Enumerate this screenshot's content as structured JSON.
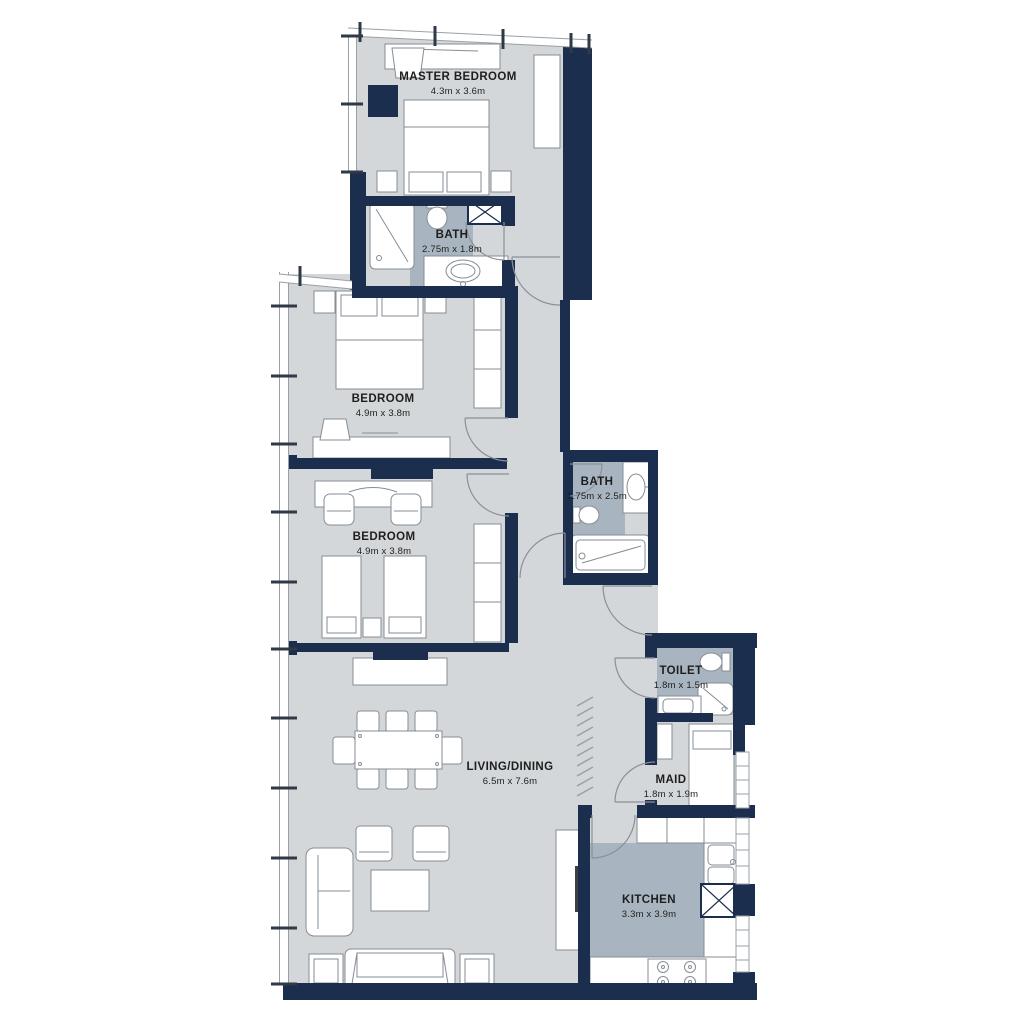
{
  "plan": {
    "title": "apartment-floor-plan",
    "palette": {
      "wall": "#1c2e4e",
      "floor": "#d3d7d9",
      "wet_floor": "#a8b5c0",
      "furniture_outline": "#868d94",
      "text": "#1e1e1e",
      "background": "#ffffff"
    }
  },
  "rooms": [
    {
      "name": "MASTER BEDROOM",
      "dims": "4.3m x 3.6m"
    },
    {
      "name": "BATH",
      "dims": "2.75m x 1.8m"
    },
    {
      "name": "BEDROOM",
      "dims": "4.9m x 3.8m"
    },
    {
      "name": "BEDROOM",
      "dims": "4.9m x 3.8m"
    },
    {
      "name": "BATH",
      "dims": "1.75m x 2.5m"
    },
    {
      "name": "TOILET",
      "dims": "1.8m x 1.5m"
    },
    {
      "name": "MAID",
      "dims": "1.8m x 1.9m"
    },
    {
      "name": "LIVING/DINING",
      "dims": "6.5m x 7.6m"
    },
    {
      "name": "KITCHEN",
      "dims": "3.3m x 3.9m"
    }
  ]
}
